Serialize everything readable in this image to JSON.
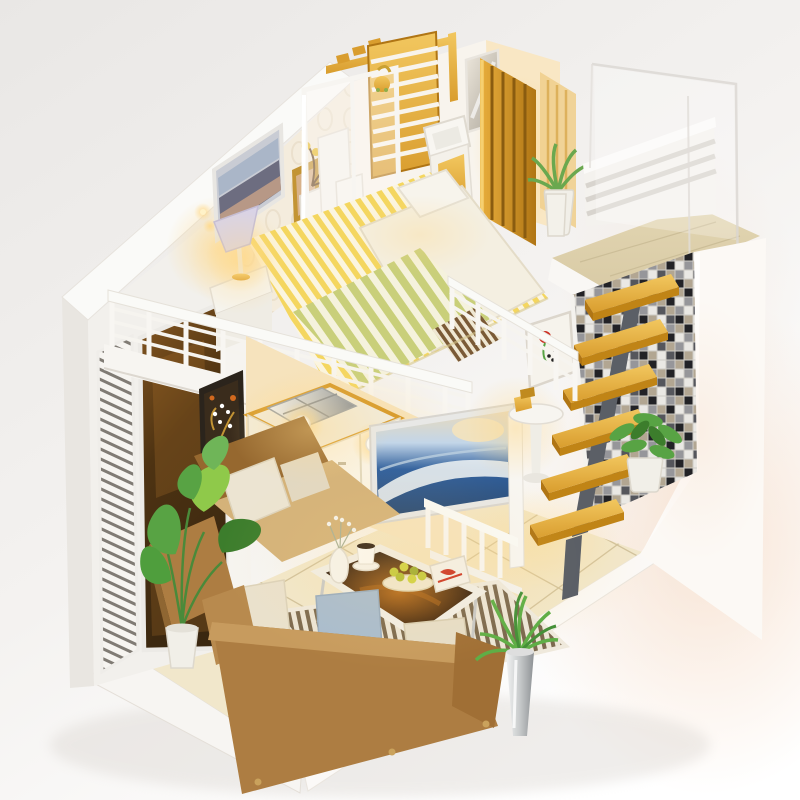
{
  "scene": {
    "type": "product-photo",
    "subject": "diy-miniature-loft-dollhouse",
    "view": "three-quarter elevated",
    "staircase": {
      "tread_count": 6,
      "material": "golden-wood",
      "stringer": "gray-metal"
    },
    "rooms": {
      "bedroom_upstairs": [
        "striped-bed",
        "white-duvet",
        "pillow",
        "table-lamp",
        "nightstand",
        "cityscape-picture",
        "photo-frame",
        "red-yellow-flowers",
        "headboard",
        "wall-sconce"
      ],
      "bathroom": [
        "glass-shower",
        "gold-shower-head",
        "toilet",
        "wash-basin",
        "mirror",
        "blue-mosaic-floor",
        "striped-bath-mat",
        "gold-slat-screens",
        "gold-trellis",
        "succulent-plant"
      ],
      "landing": [
        "acrylic-panels",
        "white-slat-railing",
        "wood-floor"
      ],
      "living_room_downstairs": [
        "burlap-sofa-front",
        "burlap-sofa-left",
        "cream-pillows",
        "blue-pillow",
        "coffee-table",
        "flower-vase",
        "coffee-cup",
        "fruit-bowl",
        "magazine",
        "striped-rug",
        "taro-plant",
        "chrome-vase-plant",
        "kitchen-counter",
        "metal-sink",
        "blossom-artwork",
        "seascape-picture",
        "baluster-railing",
        "round-side-table",
        "stair-plant",
        "flower-print"
      ]
    },
    "exterior": [
      "white-base-platform",
      "cream-tile-floor",
      "left-wall-louver-shutter",
      "amber-tinted-window",
      "mosaic-accent-wall",
      "balcony-railing",
      "warm-led-lighting"
    ]
  },
  "palette": {
    "bg_top": "#e9e7e5",
    "bg_bottom": "#ffffff",
    "shadow_pink": "#f6ddc9",
    "platform": "#f7f5f2",
    "white": "#ffffff",
    "wall_white": "#f2f0ec",
    "wall_bright": "#fafaf8",
    "wallpaper": "#f4ecdd",
    "window_dark": "#4e3312",
    "window_mid": "#8a5a22",
    "railing": "#fafaf7",
    "gold": "#d99d2e",
    "gold_dark": "#b07514",
    "gold_light": "#f2c75f",
    "stringer_gray": "#5b5f66",
    "mosaic_black": "#222226",
    "mosaic_gray": "#96969a",
    "mosaic_tan": "#b2a692",
    "mosaic_white": "#eae8e4",
    "tile_blue": "#3f63a1",
    "tile_blue_dark": "#2a4c88",
    "tile_blue_light": "#8aa6cf",
    "wood_floor": "#d8caa5",
    "tile_floor": "#f1e7cb",
    "tile_line": "#c5b48c",
    "burlap": "#ad7d42",
    "burlap_light": "#d4b279",
    "burlap_dark": "#96682f",
    "pillow_cream": "#eae1cd",
    "pillow_blue": "#a8bccf",
    "leaf_green": "#58a344",
    "leaf_dark": "#3c7d2c",
    "leaf_light": "#8fc94a",
    "pot_white": "#f1efe8",
    "chrome": "#c6c9ca",
    "bed_yellow": "#f4d65f",
    "bed_cream": "#fbf5e0",
    "blanket_stripe": "#c9cf7a",
    "duvet_white": "#f4efe1",
    "lamp_shade": "#d9d3e6",
    "glow": "#ffd98a",
    "table_top": "#2e1c0e",
    "table_amber": "#b56a1a",
    "sea_blue": "#30609e",
    "sky_light": "#c3d6e8",
    "rug_dark": "#7c694e",
    "rug_cream": "#ece5d5",
    "frame_dark": "#2b241c",
    "frame_gold": "#c39434",
    "fruit_green": "#c3ca39",
    "flower_red": "#cc2d22",
    "flower_yellow": "#e7bb2e",
    "mat_orange": "#d8903a"
  }
}
